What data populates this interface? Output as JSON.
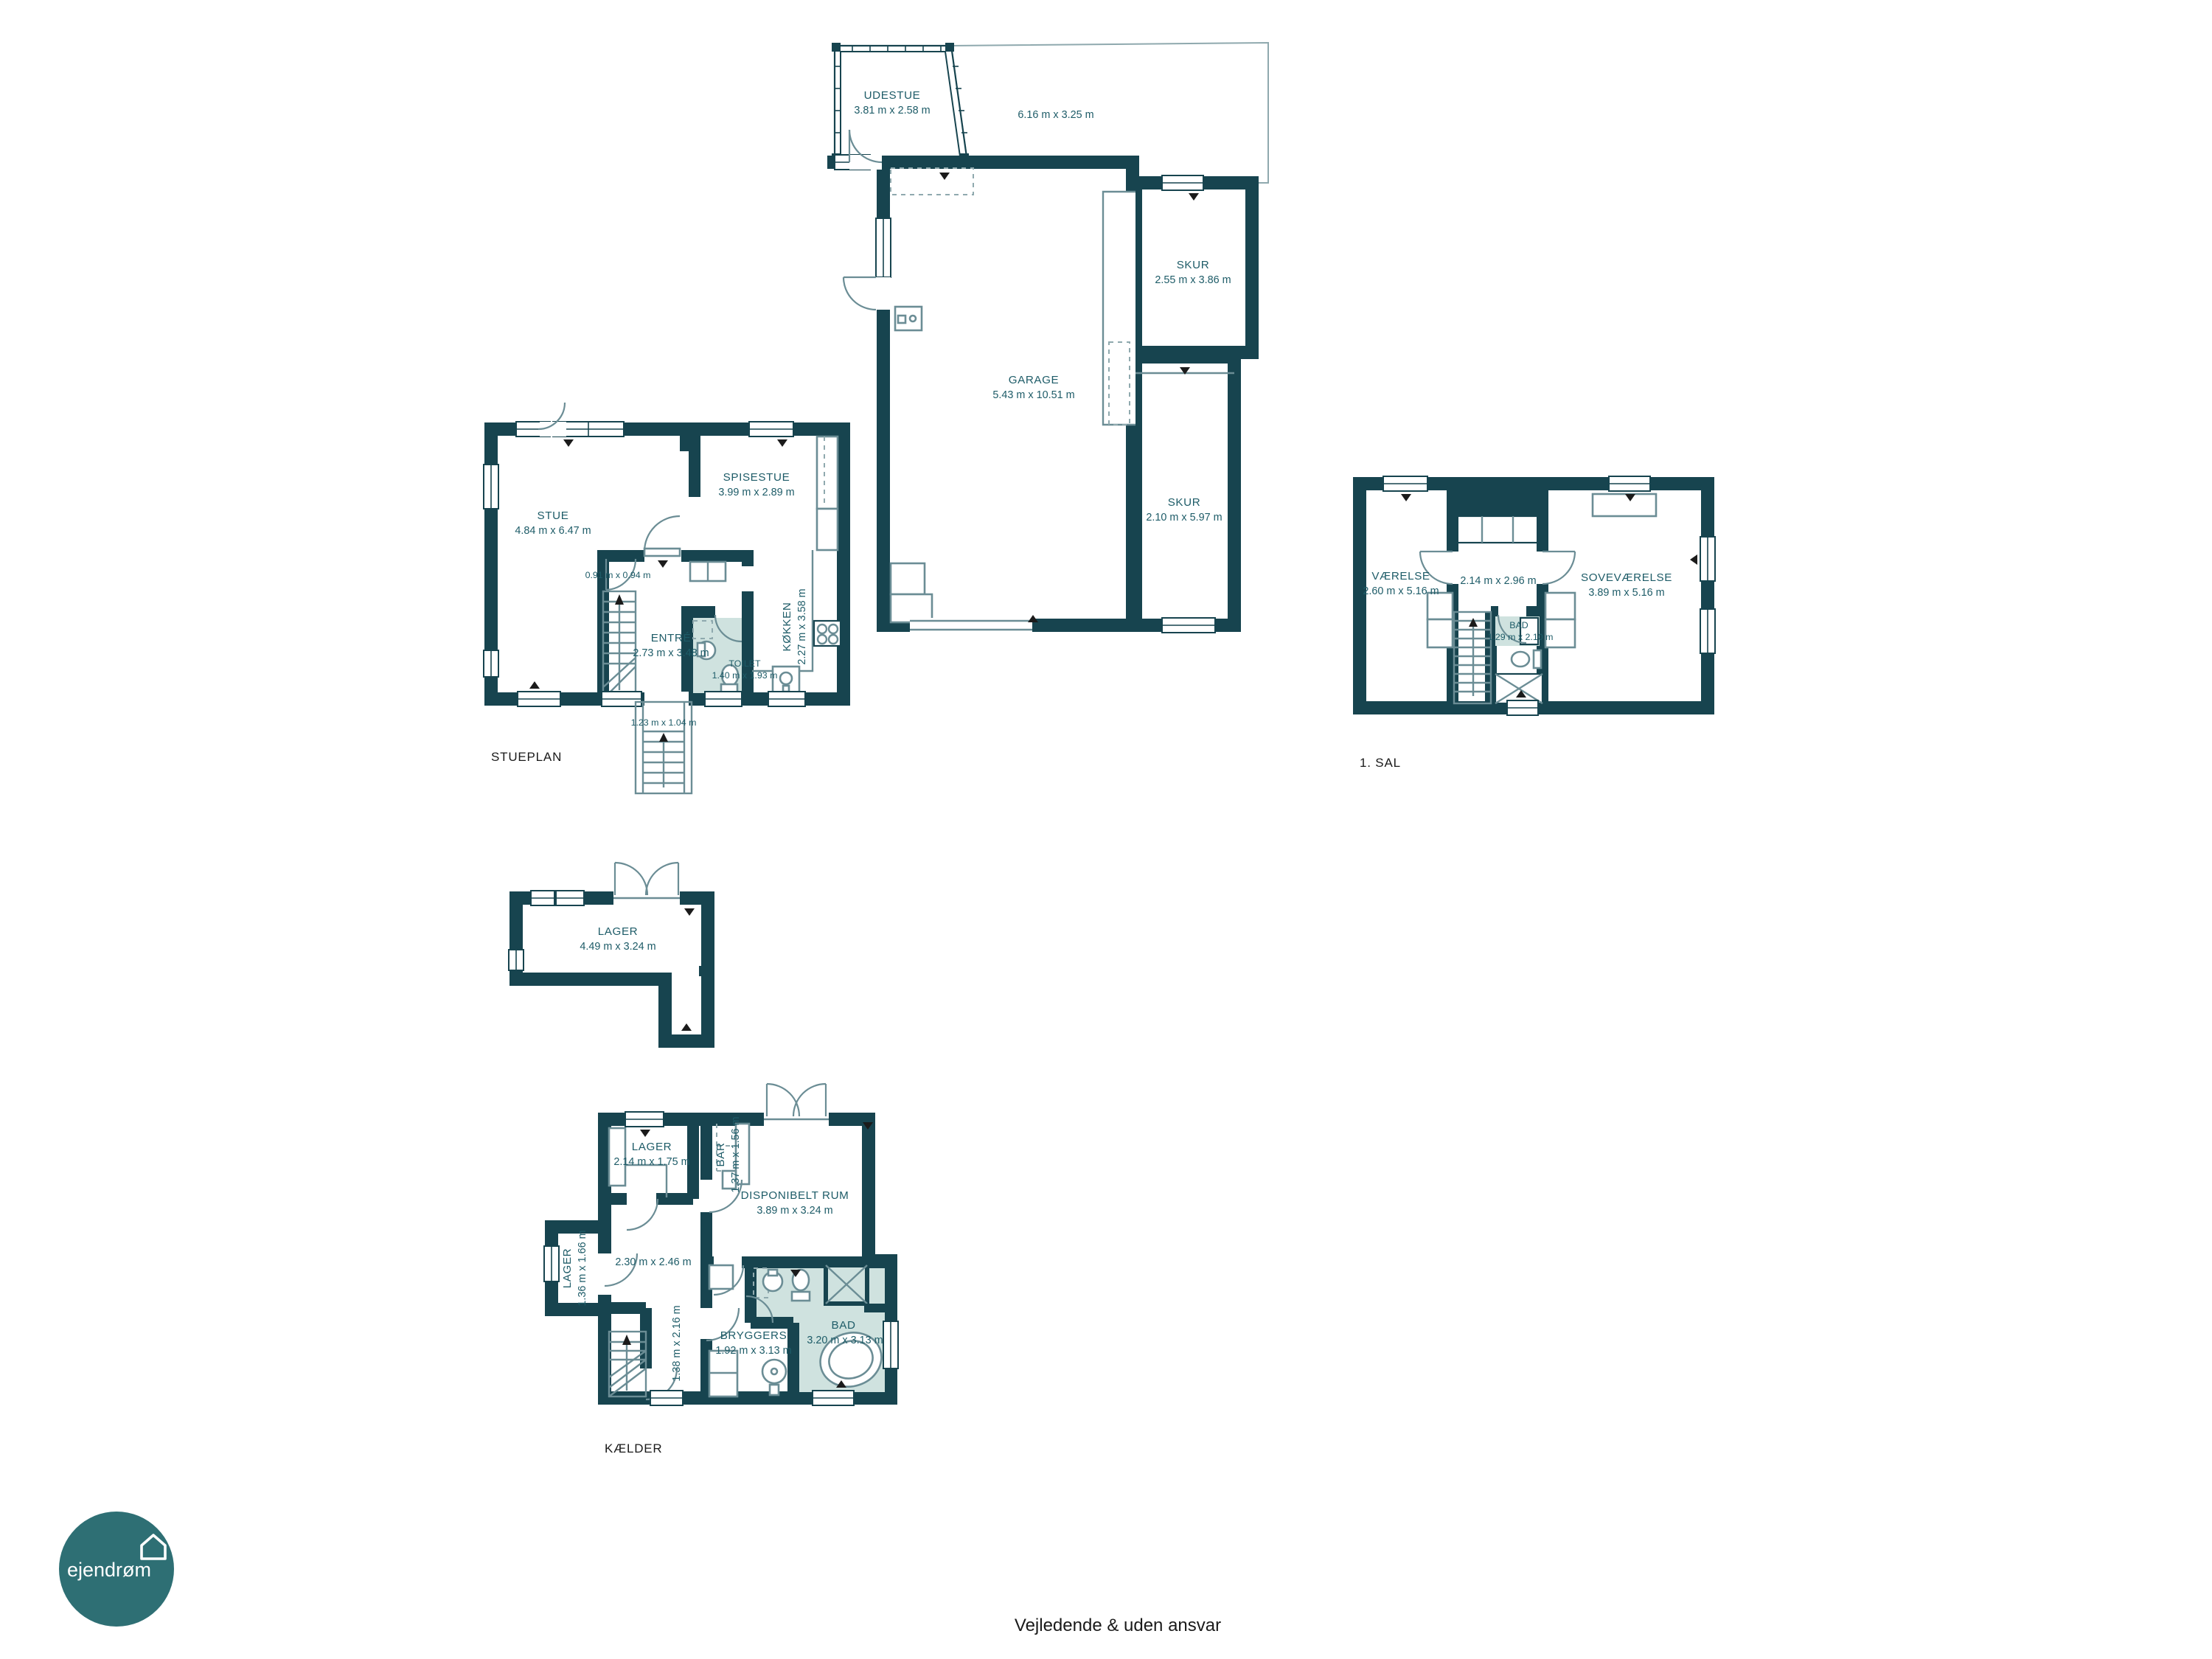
{
  "colors": {
    "wall": "#17444f",
    "room_label": "#1e5c68",
    "bath_fill": "#cfe2df",
    "fixture_line": "#6b8d95",
    "floor_label": "#1a1a1a",
    "logo_bg": "#2e6f74"
  },
  "logo": {
    "text": "ejendrøm"
  },
  "footer": {
    "disclaimer": "Vejledende & uden ansvar"
  },
  "plans": {
    "garage": {
      "udestue": {
        "name": "UDESTUE",
        "dims": "3.81 m x 2.58 m"
      },
      "terrace": {
        "dims": "6.16 m x 3.25 m"
      },
      "garage": {
        "name": "GARAGE",
        "dims": "5.43 m x 10.51 m"
      },
      "skur_top": {
        "name": "SKUR",
        "dims": "2.55 m x 3.86 m"
      },
      "skur_bottom": {
        "name": "SKUR",
        "dims": "2.10 m x 5.97 m"
      }
    },
    "stueplan": {
      "label": "STUEPLAN",
      "stue": {
        "name": "STUE",
        "dims": "4.84 m x 6.47 m"
      },
      "spisestue": {
        "name": "SPISESTUE",
        "dims": "3.99 m x 2.89 m"
      },
      "koekken": {
        "name": "KØKKEN",
        "dims": "2.27 m x 3.58 m"
      },
      "entre": {
        "name": "ENTRÉ",
        "dims": "2.73 m x 3.48 m"
      },
      "toilet": {
        "name": "TOILET",
        "dims": "1.40 m x 1.93 m"
      },
      "vestibule": {
        "dims": "0.91 m x 0.94 m"
      },
      "ext_stair": {
        "dims": "1.23 m x 1.04 m"
      }
    },
    "first_floor": {
      "label": "1. SAL",
      "vaerelse": {
        "name": "VÆRELSE",
        "dims": "2.60 m x 5.16 m"
      },
      "mid_room": {
        "dims": "2.14 m x 2.96 m"
      },
      "sovevaerelse": {
        "name": "SOVEVÆRELSE",
        "dims": "3.89 m x 5.16 m"
      },
      "bad": {
        "name": "BAD",
        "dims": "1.29 m x 2.10 m"
      }
    },
    "lager_floor": {
      "lager": {
        "name": "LAGER",
        "dims": "4.49 m x 3.24 m"
      }
    },
    "kaelder": {
      "label": "KÆLDER",
      "lager_top": {
        "name": "LAGER",
        "dims": "2.14 m x 1.75 m"
      },
      "bar": {
        "name": "BAR",
        "dims": "1.37 m x 1.56 m"
      },
      "disponibelt": {
        "name": "DISPONIBELT RUM",
        "dims": "3.89 m x 3.24 m"
      },
      "lager_small": {
        "name": "LAGER",
        "dims": "1.36 m x 1.66 m"
      },
      "mid_room": {
        "dims": "2.30 m x 2.46 m"
      },
      "corridor": {
        "dims": "1.38 m x 2.16 m"
      },
      "bryggers": {
        "name": "BRYGGERS",
        "dims": "1.92 m x 3.13 m"
      },
      "bad": {
        "name": "BAD",
        "dims": "3.20 m x 3.13 m"
      }
    }
  }
}
